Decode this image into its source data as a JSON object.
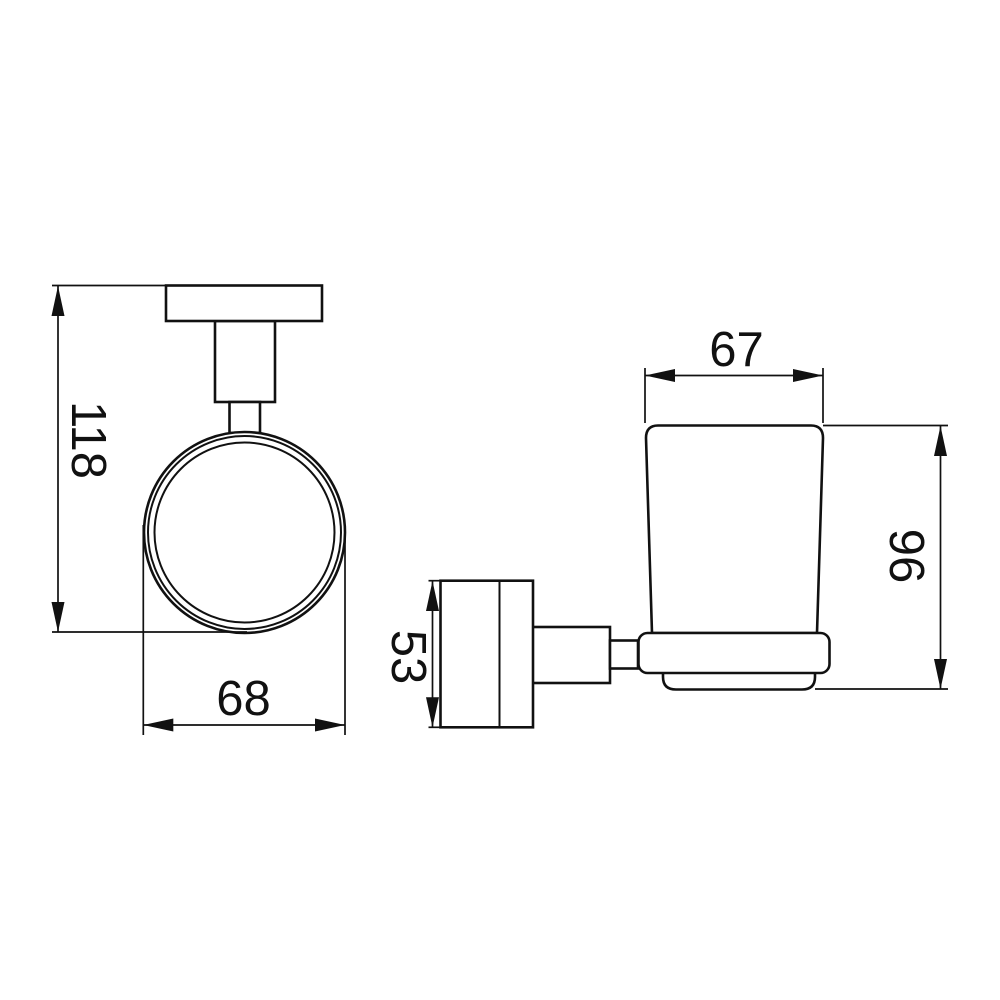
{
  "drawing": {
    "type": "technical-drawing",
    "subject": "wall-mounted glass tumbler holder, two orthographic views",
    "colors": {
      "background": "#ffffff",
      "line": "#111111"
    },
    "dimensions": {
      "front_overall_height": "118",
      "front_holder_width": "68",
      "side_cup_top_width": "67",
      "side_bracket_height": "53",
      "side_cup_height": "96"
    }
  }
}
